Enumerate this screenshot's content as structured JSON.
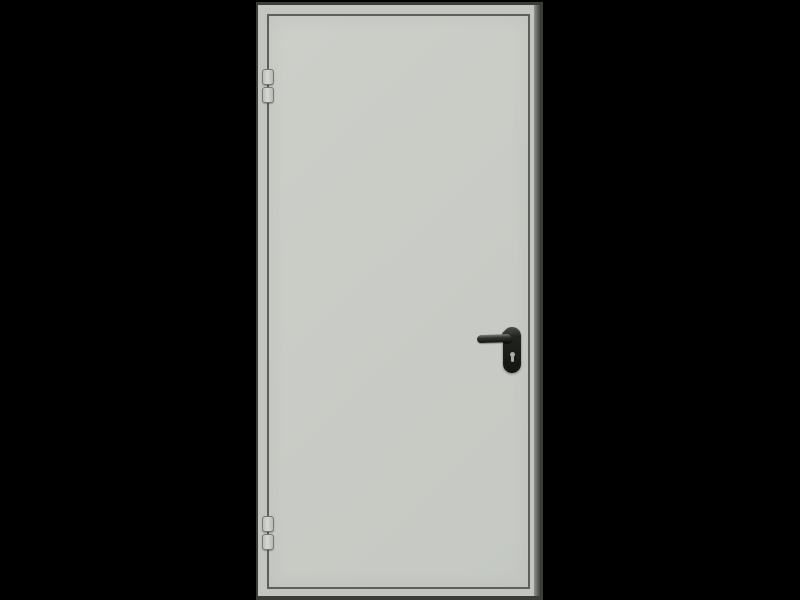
{
  "scene": {
    "description": "3D product render of a closed single-leaf grey steel door with frame, shown front-on against a solid black background",
    "view": "front",
    "background": "black",
    "visible_text": ""
  },
  "door": {
    "frame_label": "door frame",
    "leaf_label": "door leaf",
    "hinge_side": "left",
    "handle_side": "right",
    "hinge_count": 2,
    "knuckles_per_hinge": 2,
    "top_hinge_label": "top hinge",
    "bottom_hinge_label": "bottom hinge",
    "handle_label": "black lever handle on rounded escutcheon plate",
    "lever_label": "lever handle pointing left",
    "escutcheon_label": "escutcheon plate",
    "keyhole_label": "euro cylinder keyhole"
  },
  "colors": {
    "background": "#000000",
    "frame_fill": "#c3c6c0",
    "frame_outline": "#3a3d38",
    "right_reveal_light": "#8f928b",
    "right_reveal_dark": "#41443d",
    "leaf_fill": "#cccec8",
    "leaf_fill_dark": "#c6c9c3",
    "leaf_outline": "#5d605a",
    "hinge_fill": "#d5d7d2",
    "hinge_outline": "#75786f",
    "handle_body": "#22251f",
    "handle_dark": "#121510",
    "handle_highlight": "#7c807a",
    "keyhole": "#a9aba4"
  }
}
